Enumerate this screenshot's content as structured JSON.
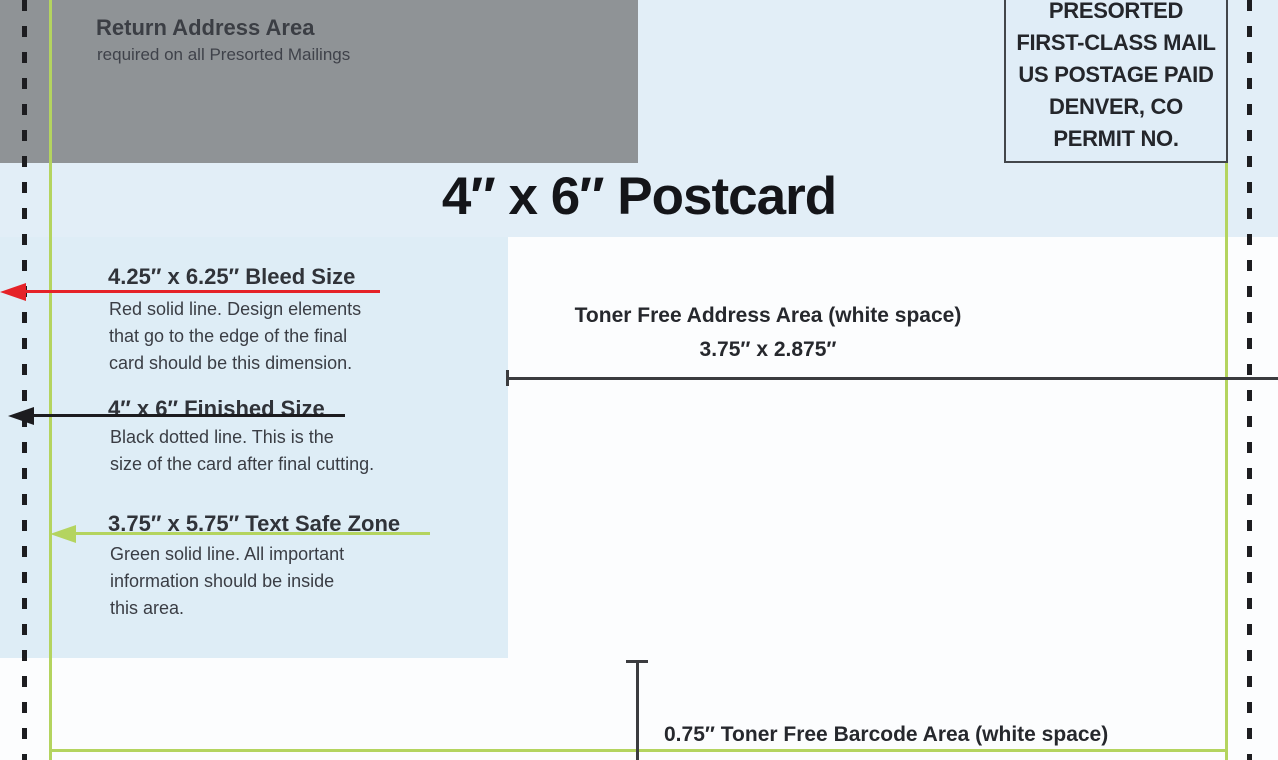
{
  "diagram_title": "4″ x 6″ Postcard",
  "return_address_area": {
    "title": "Return Address Area",
    "subtitle": "required on all Presorted Mailings"
  },
  "postage_indicia": {
    "lines": [
      "PRESORTED",
      "FIRST-CLASS MAIL",
      "US POSTAGE PAID",
      "DENVER, CO",
      "PERMIT NO."
    ]
  },
  "annotations": {
    "bleed": {
      "heading": "4.25″ x 6.25″ Bleed Size",
      "description": [
        "Red solid line. Design elements",
        "that go to the edge of the final",
        "card should be this dimension."
      ]
    },
    "finished": {
      "heading": "4″ x 6″ Finished Size",
      "description": [
        "Black dotted line. This is the",
        "size of the card after final cutting."
      ]
    },
    "safe_zone": {
      "heading": "3.75″ x 5.75″ Text Safe Zone",
      "description": [
        "Green solid line. All important",
        "information should be inside",
        "this area."
      ]
    }
  },
  "address_area": {
    "label": "Toner Free Address Area (white space)",
    "dimensions": "3.75″ x 2.875″"
  },
  "barcode_area": {
    "label": "0.75″ Toner Free Barcode Area (white space)"
  },
  "colors": {
    "bleed_line": "#e52228",
    "finished_line": "#1c1c1f",
    "safe_zone_line": "#b4d45f",
    "background_blue": "#e2eef7",
    "return_area_gray": "#8f9396",
    "white_space": "#fcfdfe",
    "dimension_line": "#3b3c3f"
  }
}
